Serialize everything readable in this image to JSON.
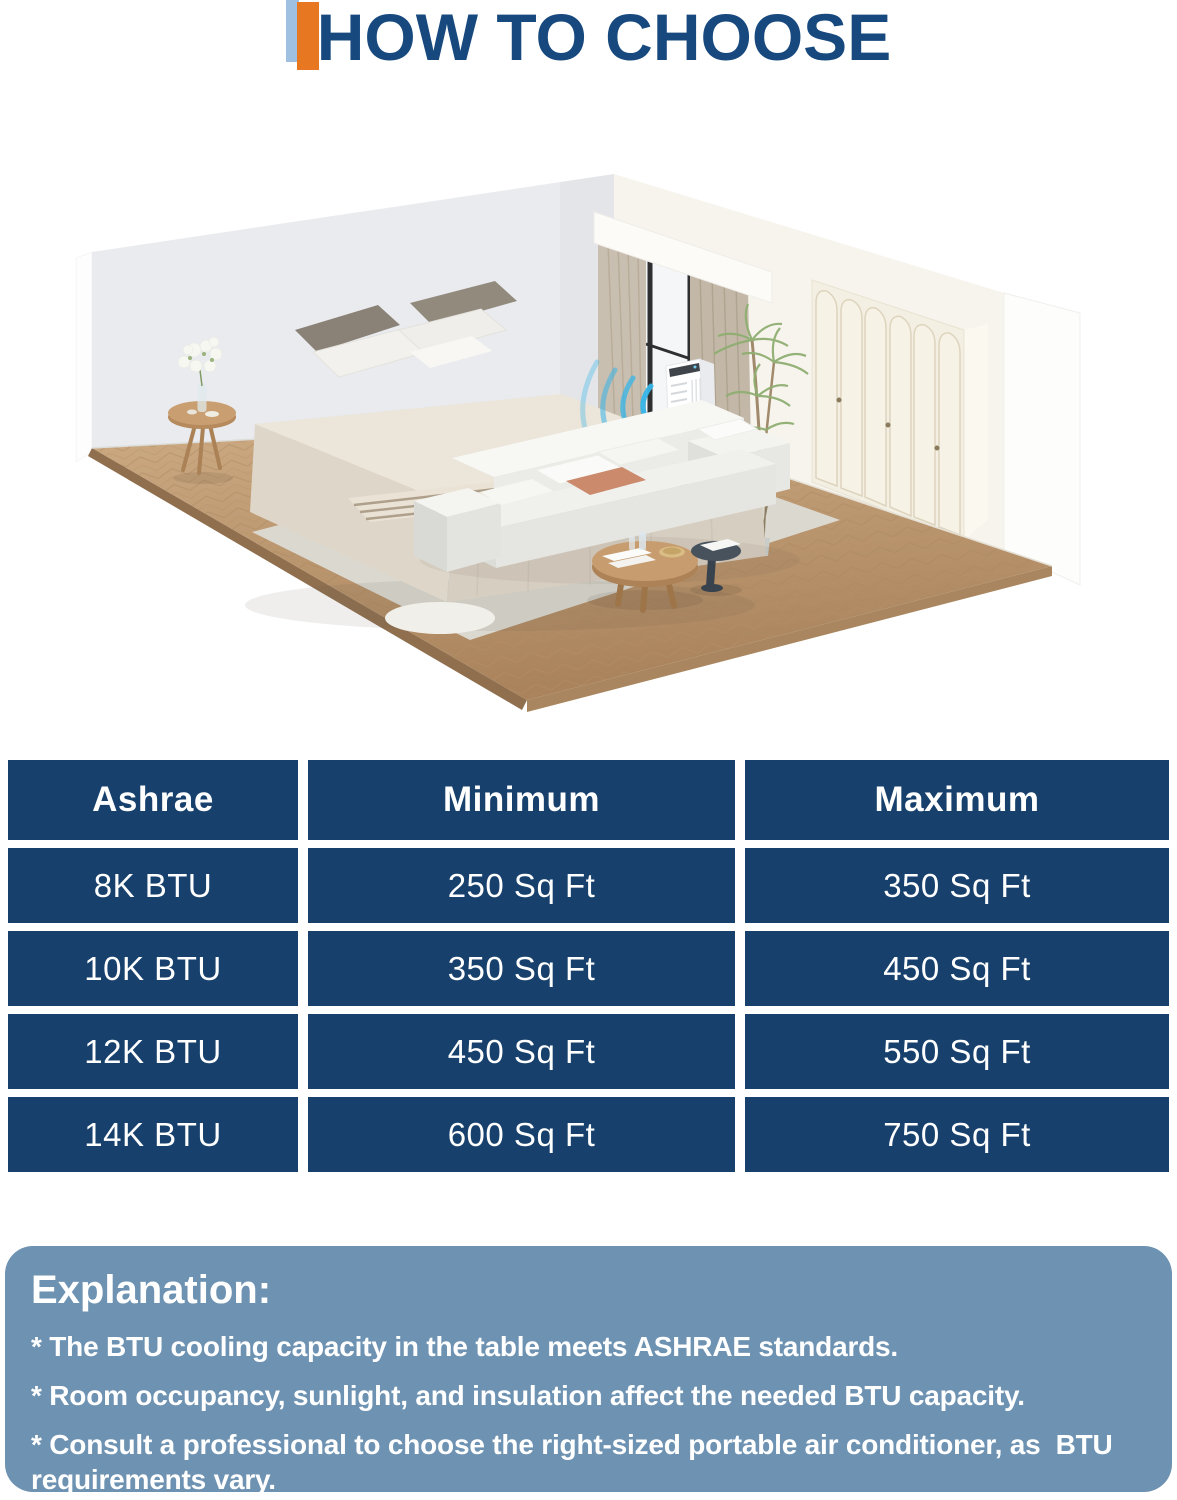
{
  "header": {
    "title": "HOW TO CHOOSE",
    "title_color": "#17497e",
    "accent_blue": "#9fc0e0",
    "accent_orange": "#e87722"
  },
  "illustration": {
    "description": "isometric bedroom with portable air conditioner blowing cool air",
    "airflow_color": "#35b5e9"
  },
  "table": {
    "cell_bg": "#17416c",
    "text_color": "#ffffff",
    "headers": [
      "Ashrae",
      "Minimum",
      "Maximum"
    ],
    "rows": [
      [
        "8K BTU",
        "250 Sq Ft",
        "350 Sq Ft"
      ],
      [
        "10K BTU",
        "350 Sq Ft",
        "450 Sq Ft"
      ],
      [
        "12K BTU",
        "450 Sq Ft",
        "550 Sq Ft"
      ],
      [
        "14K BTU",
        "600 Sq Ft",
        "750 Sq Ft"
      ]
    ]
  },
  "explanation": {
    "bg": "#6e92b2",
    "heading": "Explanation:",
    "bullets": [
      "* The BTU cooling capacity in the table meets ASHRAE standards.",
      "* Room occupancy, sunlight, and insulation affect the needed BTU capacity.",
      "* Consult a professional to choose the right-sized portable air conditioner, as  BTU requirements vary."
    ]
  }
}
